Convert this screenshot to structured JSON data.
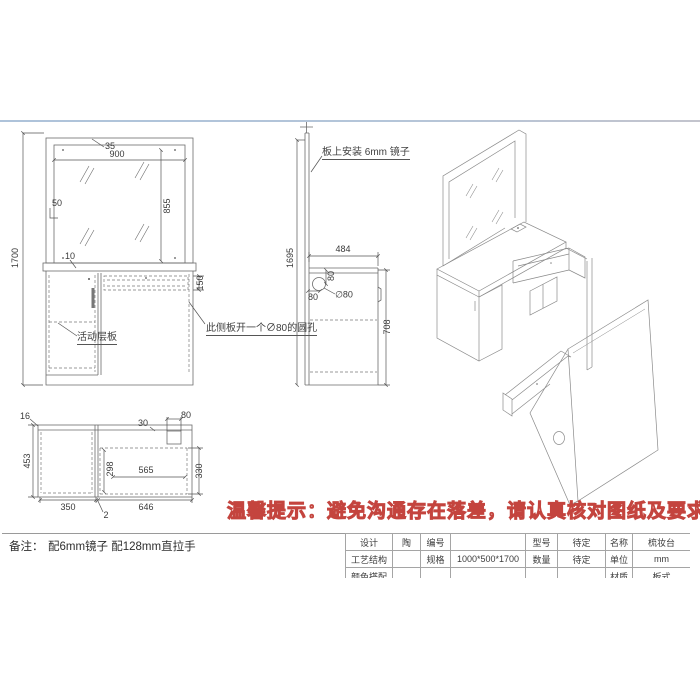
{
  "front_view": {
    "overall_height": "1700",
    "mirror_offset": "35",
    "mirror_width": "900",
    "mirror_side_gap": "50",
    "mirror_height": "855",
    "top_gap": "10",
    "drawer_height": "150",
    "shelf_label": "活动层板",
    "hole_note": "此侧板开一个∅80的圆孔"
  },
  "side_view": {
    "mirror_note": "板上安装 6mm 镜子",
    "panel_height": "1695",
    "depth": "484",
    "cabinet_height": "708",
    "hole_offset_top": "80",
    "hole_offset_side": "80",
    "hole_diameter": "∅80"
  },
  "plan_view": {
    "panel_thickness": "16",
    "back_offset": "30",
    "hole_width": "80",
    "depth": "453",
    "inner_depth": "298",
    "opening_width": "565",
    "opening_depth": "330",
    "left_width": "350",
    "right_width": "646",
    "divider_gap": "2"
  },
  "notice": {
    "text": "温馨提示：避免沟通存在落差，请认真核对图纸及要求！"
  },
  "remark": {
    "label": "备注：",
    "text": "配6mm镜子 配128mm直拉手"
  },
  "title_block": {
    "rows": [
      {
        "c1": "设计",
        "c2": "陶",
        "c3": "编号",
        "c4": "",
        "c5": "型号",
        "c6": "待定",
        "c7": "名称",
        "c8": "梳妆台"
      },
      {
        "c1": "工艺结构",
        "c2": "",
        "c3": "规格",
        "c4": "1000*500*1700",
        "c5": "数量",
        "c6": "待定",
        "c7": "单位",
        "c8": "mm"
      },
      {
        "c1": "颜色搭配",
        "c2": "",
        "c3": "",
        "c4": "",
        "c5": "",
        "c6": "",
        "c7": "材质",
        "c8": "板式"
      }
    ]
  }
}
